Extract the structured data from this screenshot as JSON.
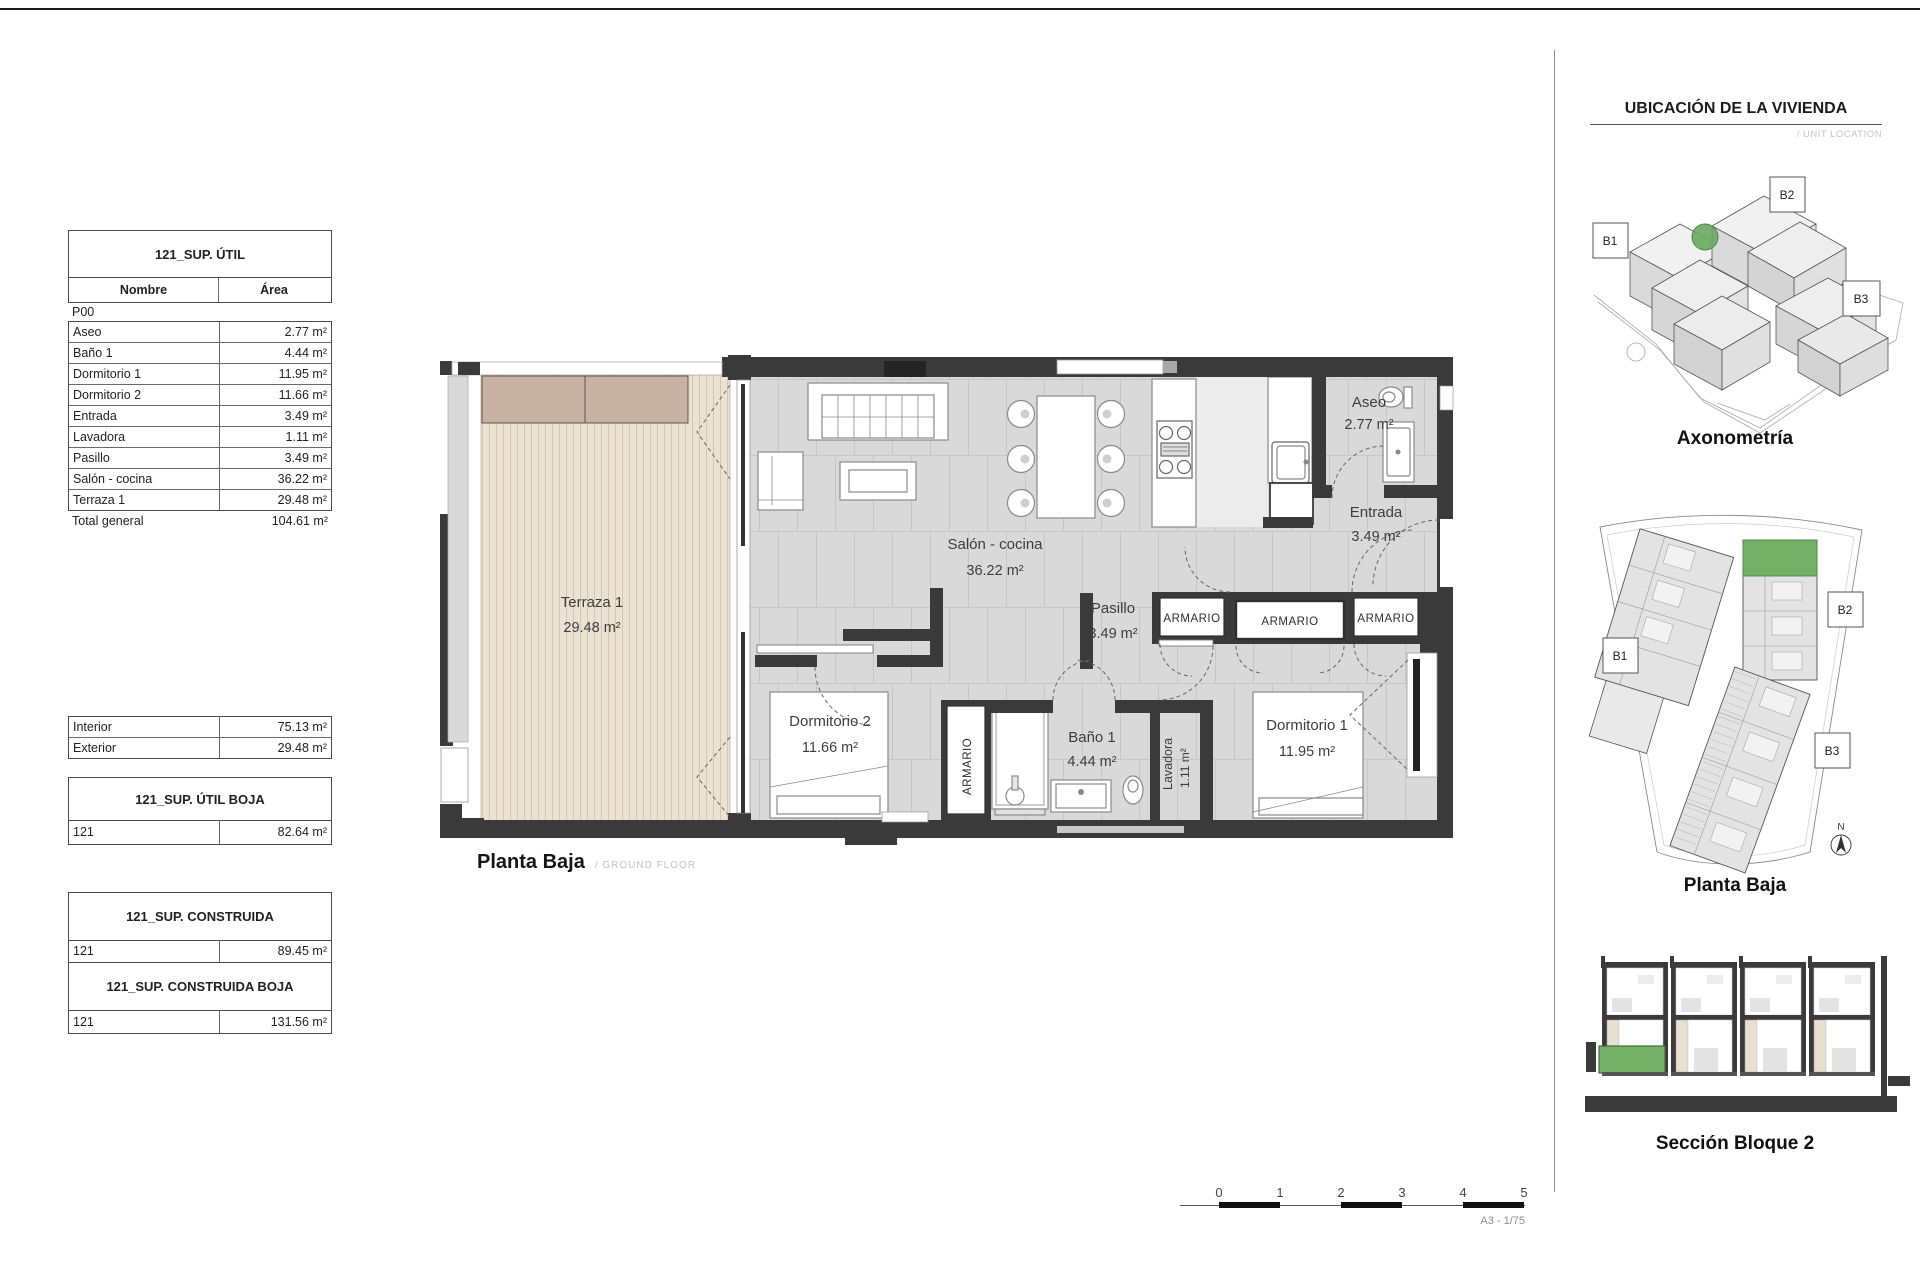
{
  "page": {
    "scale_ticks": [
      "0",
      "1",
      "2",
      "3",
      "4",
      "5"
    ],
    "scale_note": "A3 - 1/75"
  },
  "tables": {
    "util": {
      "title": "121_SUP. ÚTIL",
      "col_name": "Nombre",
      "col_area": "Área",
      "group": "P00",
      "rows": [
        {
          "name": "Aseo",
          "area": "2.77 m²"
        },
        {
          "name": "Baño 1",
          "area": "4.44 m²"
        },
        {
          "name": "Dormitorio 1",
          "area": "11.95 m²"
        },
        {
          "name": "Dormitorio 2",
          "area": "11.66 m²"
        },
        {
          "name": "Entrada",
          "area": "3.49 m²"
        },
        {
          "name": "Lavadora",
          "area": "1.11 m²"
        },
        {
          "name": "Pasillo",
          "area": "3.49 m²"
        },
        {
          "name": "Salón - cocina",
          "area": "36.22 m²"
        },
        {
          "name": "Terraza 1",
          "area": "29.48 m²"
        }
      ],
      "total_label": "Total general",
      "total_value": "104.61 m²"
    },
    "int_ext": {
      "rows": [
        {
          "name": "Interior",
          "area": "75.13 m²"
        },
        {
          "name": "Exterior",
          "area": "29.48 m²"
        }
      ]
    },
    "util_boja": {
      "title": "121_SUP. ÚTIL BOJA",
      "row": {
        "name": "121",
        "area": "82.64 m²"
      }
    },
    "construida": {
      "title": "121_SUP. CONSTRUIDA",
      "row": {
        "name": "121",
        "area": "89.45 m²"
      }
    },
    "construida_boja": {
      "title": "121_SUP. CONSTRUIDA BOJA",
      "row": {
        "name": "121",
        "area": "131.56 m²"
      }
    }
  },
  "plan": {
    "caption": "Planta Baja",
    "caption_sub": "/ GROUND FLOOR",
    "rooms": {
      "terraza": {
        "name": "Terraza 1",
        "area": "29.48 m²"
      },
      "salon": {
        "name": "Salón - cocina",
        "area": "36.22 m²"
      },
      "pasillo": {
        "name": "Pasillo",
        "area": "3.49 m²"
      },
      "aseo": {
        "name": "Aseo",
        "area": "2.77 m²"
      },
      "entrada": {
        "name": "Entrada",
        "area": "3.49 m²"
      },
      "dormitorio2": {
        "name": "Dormitorio 2",
        "area": "11.66 m²"
      },
      "bano": {
        "name": "Baño 1",
        "area": "4.44 m²"
      },
      "lavadora": {
        "name": "Lavadora",
        "area": "1.11 m²"
      },
      "dormitorio1": {
        "name": "Dormitorio 1",
        "area": "11.95 m²"
      }
    },
    "closets": [
      "ARMARIO",
      "ARMARIO",
      "ARMARIO",
      "ARMARIO"
    ]
  },
  "sidebar": {
    "title": "UBICACIÓN DE LA VIVIENDA",
    "subtitle": "/ UNIT LOCATION",
    "axon": {
      "caption": "Axonometría",
      "b1": "B1",
      "b2": "B2",
      "b3": "B3"
    },
    "site": {
      "caption": "Planta Baja",
      "b1": "B1",
      "b2": "B2",
      "b3": "B3",
      "north": "N"
    },
    "section": {
      "caption": "Sección Bloque 2"
    }
  },
  "colors": {
    "highlight": "#74b066",
    "wall": "#3a3a3a",
    "deck": "#ece2d3",
    "planter": "#c8b2a3",
    "floor": "#d9d9d9"
  }
}
